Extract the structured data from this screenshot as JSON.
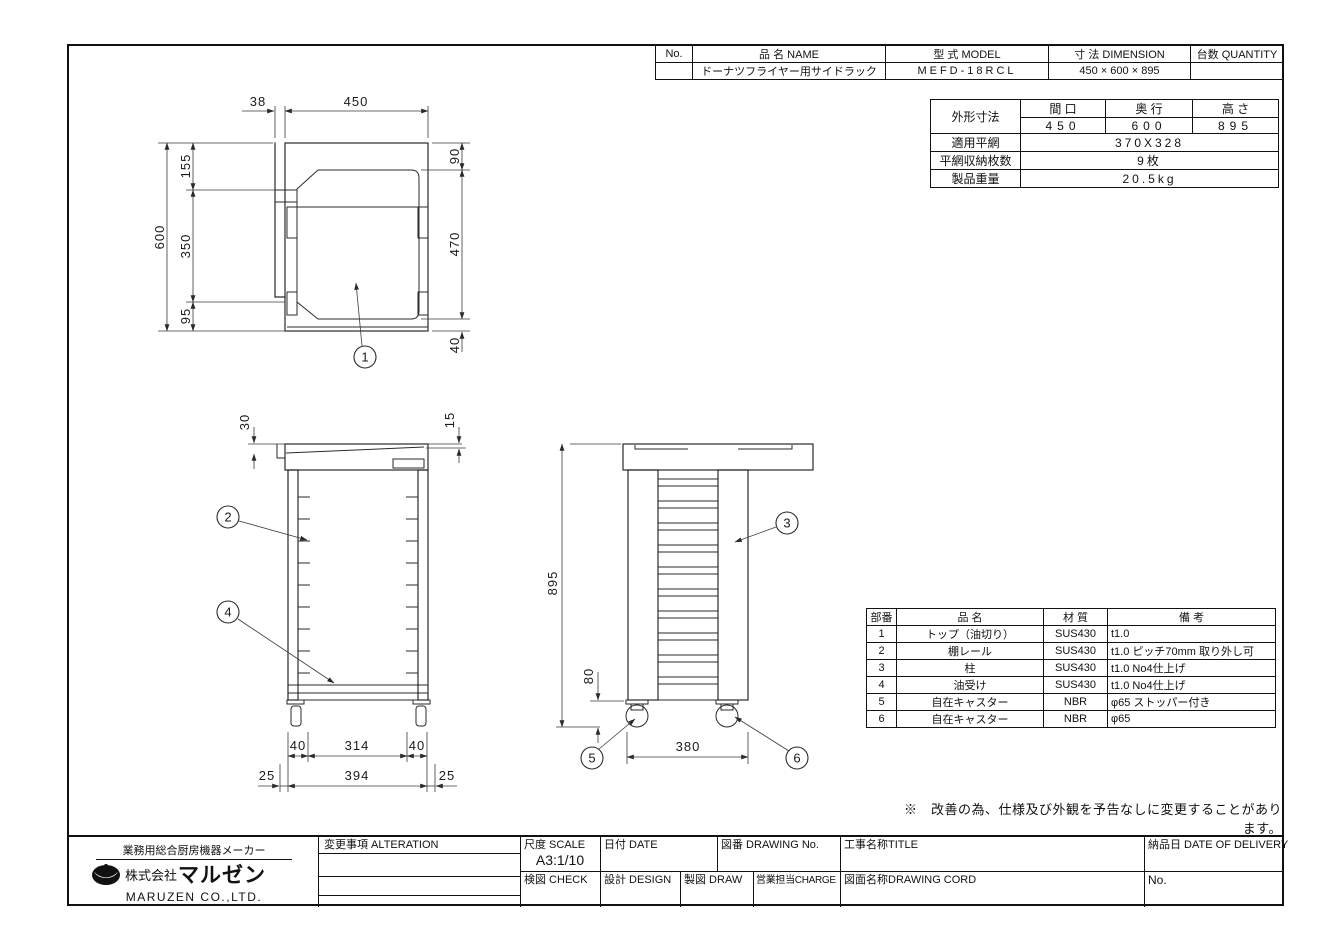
{
  "header_table": {
    "no_label": "No.",
    "name_label": "品 名 NAME",
    "model_label": "型 式 MODEL",
    "dimension_label": "寸 法 DIMENSION",
    "quantity_label": "台数 QUANTITY",
    "name_value": "ドーナツフライヤー用サイドラック",
    "model_value": "MEFD-18RCL",
    "dimension_value": "450 × 600 × 895",
    "no_value": "",
    "quantity_value": ""
  },
  "spec_table": {
    "overall_label": "外形寸法",
    "width_label": "間 口",
    "depth_label": "奥 行",
    "height_label": "高 さ",
    "width_value": "450",
    "depth_value": "600",
    "height_value": "895",
    "net_label": "適用平網",
    "net_value": "370X328",
    "capacity_label": "平網収納枚数",
    "capacity_value": "9枚",
    "weight_label": "製品重量",
    "weight_value": "20.5kg"
  },
  "parts_table": {
    "no_label": "部番",
    "name_label": "品 名",
    "material_label": "材 質",
    "note_label": "備 考",
    "rows": [
      {
        "no": "1",
        "name": "トップ（油切り）",
        "material": "SUS430",
        "note": "t1.0"
      },
      {
        "no": "2",
        "name": "棚レール",
        "material": "SUS430",
        "note": "t1.0 ピッチ70mm 取り外し可"
      },
      {
        "no": "3",
        "name": "柱",
        "material": "SUS430",
        "note": "t1.0 No4仕上げ"
      },
      {
        "no": "4",
        "name": "油受け",
        "material": "SUS430",
        "note": "t1.0 No4仕上げ"
      },
      {
        "no": "5",
        "name": "自在キャスター",
        "material": "NBR",
        "note": "φ65 ストッパー付き"
      },
      {
        "no": "6",
        "name": "自在キャスター",
        "material": "NBR",
        "note": "φ65"
      }
    ]
  },
  "note": "※　改善の為、仕様及び外観を予告なしに変更することがあります。",
  "title_block": {
    "tagline": "業務用総合厨房機器メーカー",
    "company_prefix": "株式会社",
    "company_logo_text": "マルゼン",
    "company_en": "MARUZEN CO.,LTD.",
    "alteration_label": "変更事項 ALTERATION",
    "scale_label": "尺度 SCALE",
    "scale_value": "A3:1/10",
    "date_label": "日付 DATE",
    "drawing_no_label": "図番 DRAWING No.",
    "title_label": "工事名称TITLE",
    "delivery_label": "納品日 DATE OF DELIVERY",
    "check_label": "検図 CHECK",
    "design_label": "設計 DESIGN",
    "draw_label": "製図 DRAW",
    "charge_label": "営業担当CHARGE",
    "cord_label": "図面名称DRAWING CORD",
    "no_label": "No."
  },
  "views": {
    "top": {
      "d38": "38",
      "d450": "450",
      "d600": "600",
      "d155": "155",
      "d350": "350",
      "d95": "95",
      "d90": "90",
      "d470": "470",
      "d40": "40",
      "balloon": "1"
    },
    "front": {
      "d30": "30",
      "d15": "15",
      "d40a": "40",
      "d314": "314",
      "d40b": "40",
      "d25a": "25",
      "d394": "394",
      "d25b": "25",
      "balloon_rail": "2",
      "balloon_tray": "4"
    },
    "side": {
      "d895": "895",
      "d80": "80",
      "d380": "380",
      "balloon_post": "3",
      "balloon_caster_a": "5",
      "balloon_caster_b": "6"
    }
  }
}
